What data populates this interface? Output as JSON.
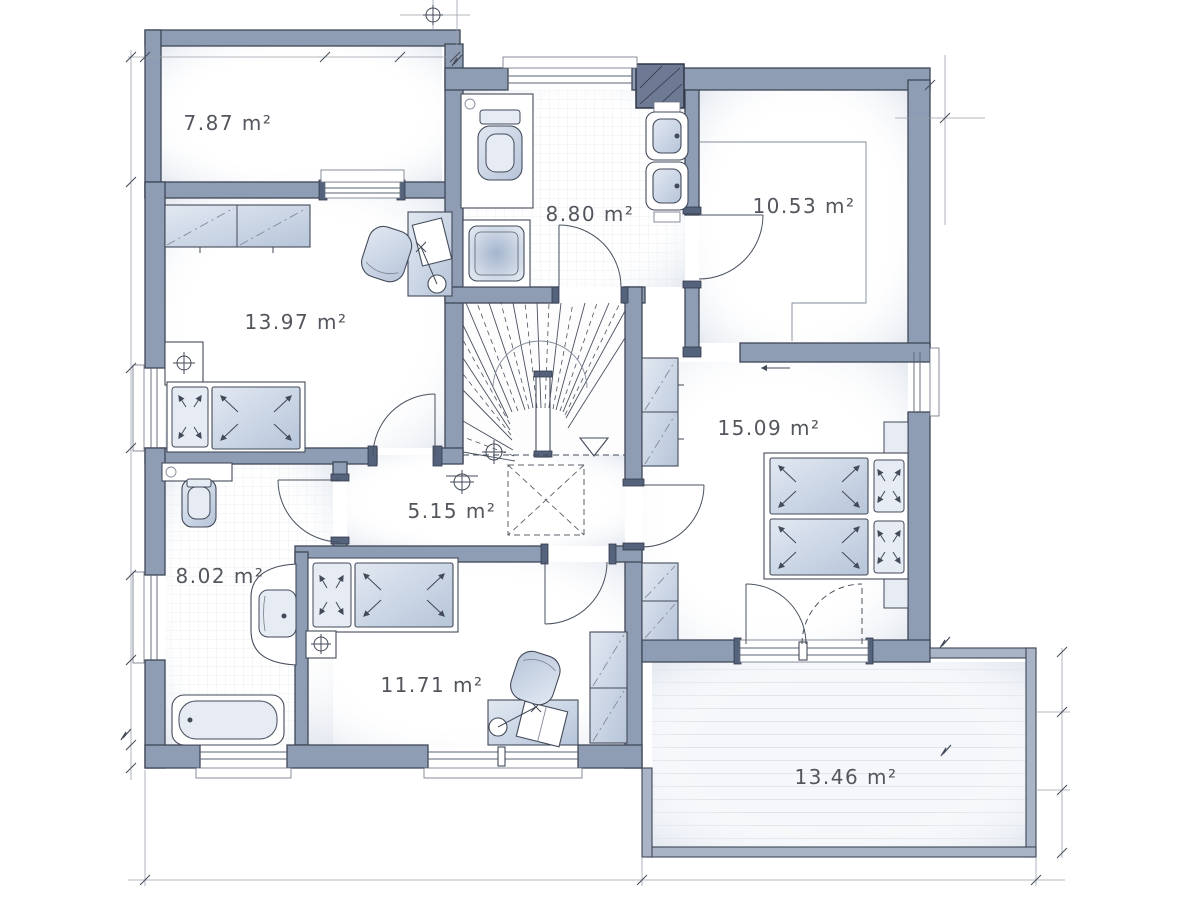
{
  "plan": {
    "rooms": [
      {
        "id": "balcony-top-left",
        "area": "7.87 m²"
      },
      {
        "id": "bathroom-top",
        "area": "8.80 m²"
      },
      {
        "id": "room-top-right",
        "area": "10.53 m²"
      },
      {
        "id": "bedroom-left",
        "area": "13.97 m²"
      },
      {
        "id": "bedroom-right",
        "area": "15.09 m²"
      },
      {
        "id": "hallway",
        "area": "5.15 m²"
      },
      {
        "id": "bathroom-left",
        "area": "8.02 m²"
      },
      {
        "id": "bedroom-bottom",
        "area": "11.71 m²"
      },
      {
        "id": "terrace-bottom-right",
        "area": "13.46 m²"
      }
    ],
    "colors": {
      "wall": "#8f9db4",
      "wall_outline": "#3f4757",
      "furniture_fill": "#ccd7e6",
      "label_text": "#53565c",
      "background": "#ffffff"
    }
  }
}
